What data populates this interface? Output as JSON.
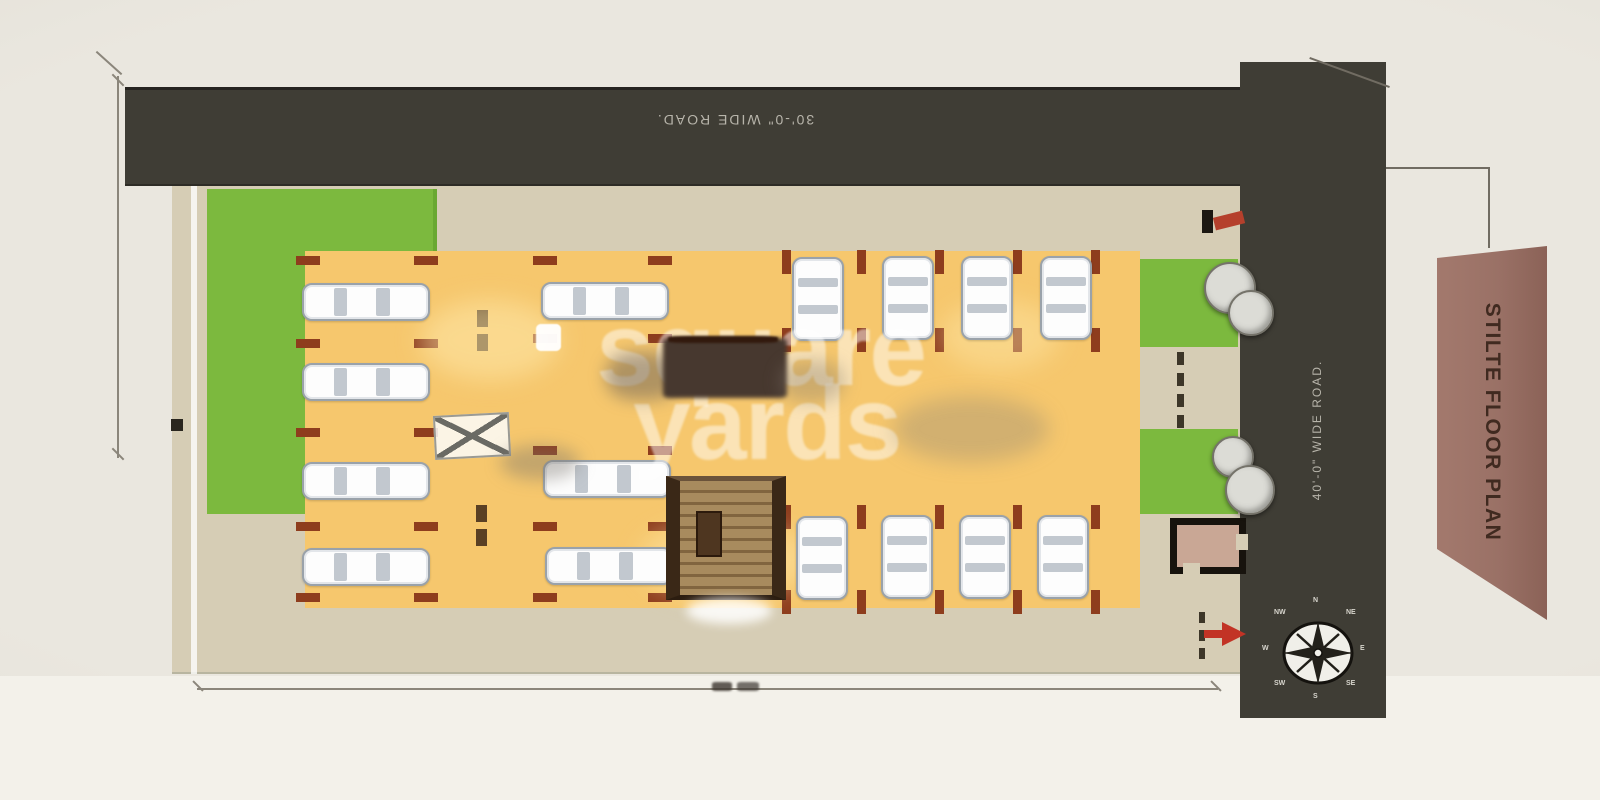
{
  "banner": {
    "label": "STILTE FLOOR PLAN"
  },
  "roads": {
    "top_label": "30'-0\" WIDE ROAD.",
    "right_label": "40'-0\" WIDE ROAD."
  },
  "watermark": {
    "word1": "square",
    "word2": "yards"
  },
  "compass": {
    "labels": [
      {
        "t": "N",
        "x": 1313,
        "y": 597
      },
      {
        "t": "NE",
        "x": 1346,
        "y": 609
      },
      {
        "t": "E",
        "x": 1360,
        "y": 645
      },
      {
        "t": "SE",
        "x": 1346,
        "y": 680
      },
      {
        "t": "S",
        "x": 1313,
        "y": 693
      },
      {
        "t": "SW",
        "x": 1274,
        "y": 680
      },
      {
        "t": "W",
        "x": 1262,
        "y": 645
      },
      {
        "t": "NW",
        "x": 1274,
        "y": 609
      }
    ]
  },
  "colors": {
    "road": "#3f3d35",
    "plot": "#d6cdb5",
    "grass": "#7cb93e",
    "parking": "#f6c76d",
    "marker": "#8e3d1d",
    "banner": "#9a7166",
    "banner_text": "#402a20",
    "arrow": "#c23325",
    "road_text": "#b7b4aa"
  },
  "plan": {
    "cars": [
      {
        "x": 302,
        "y": 283,
        "o": "h"
      },
      {
        "x": 302,
        "y": 363,
        "o": "h"
      },
      {
        "x": 302,
        "y": 462,
        "o": "h"
      },
      {
        "x": 302,
        "y": 548,
        "o": "h"
      },
      {
        "x": 541,
        "y": 282,
        "o": "h"
      },
      {
        "x": 543,
        "y": 460,
        "o": "h"
      },
      {
        "x": 545,
        "y": 547,
        "o": "h"
      },
      {
        "x": 792,
        "y": 257,
        "o": "v"
      },
      {
        "x": 882,
        "y": 256,
        "o": "v"
      },
      {
        "x": 961,
        "y": 256,
        "o": "v"
      },
      {
        "x": 1040,
        "y": 256,
        "o": "v"
      },
      {
        "x": 796,
        "y": 516,
        "o": "v"
      },
      {
        "x": 881,
        "y": 515,
        "o": "v"
      },
      {
        "x": 959,
        "y": 515,
        "o": "v"
      },
      {
        "x": 1037,
        "y": 515,
        "o": "v"
      }
    ],
    "rects": [
      {
        "x": 296,
        "y": 256,
        "w": 24,
        "h": 9,
        "n": "stall-marker"
      },
      {
        "x": 296,
        "y": 339,
        "w": 24,
        "h": 9,
        "n": "stall-marker"
      },
      {
        "x": 296,
        "y": 428,
        "w": 24,
        "h": 9,
        "n": "stall-marker"
      },
      {
        "x": 296,
        "y": 522,
        "w": 24,
        "h": 9,
        "n": "stall-marker"
      },
      {
        "x": 296,
        "y": 593,
        "w": 24,
        "h": 9,
        "n": "stall-marker"
      },
      {
        "x": 414,
        "y": 256,
        "w": 24,
        "h": 9,
        "n": "stall-marker"
      },
      {
        "x": 414,
        "y": 339,
        "w": 24,
        "h": 9,
        "n": "stall-marker"
      },
      {
        "x": 414,
        "y": 428,
        "w": 24,
        "h": 9,
        "n": "stall-marker"
      },
      {
        "x": 414,
        "y": 522,
        "w": 24,
        "h": 9,
        "n": "stall-marker"
      },
      {
        "x": 414,
        "y": 593,
        "w": 24,
        "h": 9,
        "n": "stall-marker"
      },
      {
        "x": 533,
        "y": 256,
        "w": 24,
        "h": 9,
        "n": "stall-marker"
      },
      {
        "x": 533,
        "y": 334,
        "w": 24,
        "h": 9,
        "n": "stall-marker"
      },
      {
        "x": 533,
        "y": 446,
        "w": 24,
        "h": 9,
        "n": "stall-marker"
      },
      {
        "x": 533,
        "y": 522,
        "w": 24,
        "h": 9,
        "n": "stall-marker"
      },
      {
        "x": 533,
        "y": 593,
        "w": 24,
        "h": 9,
        "n": "stall-marker"
      },
      {
        "x": 648,
        "y": 256,
        "w": 24,
        "h": 9,
        "n": "stall-marker"
      },
      {
        "x": 648,
        "y": 334,
        "w": 24,
        "h": 9,
        "n": "stall-marker"
      },
      {
        "x": 648,
        "y": 446,
        "w": 24,
        "h": 9,
        "n": "stall-marker"
      },
      {
        "x": 648,
        "y": 522,
        "w": 24,
        "h": 9,
        "n": "stall-marker"
      },
      {
        "x": 648,
        "y": 593,
        "w": 24,
        "h": 9,
        "n": "stall-marker"
      },
      {
        "x": 782,
        "y": 250,
        "w": 9,
        "h": 24,
        "n": "stall-marker"
      },
      {
        "x": 857,
        "y": 250,
        "w": 9,
        "h": 24,
        "n": "stall-marker"
      },
      {
        "x": 935,
        "y": 250,
        "w": 9,
        "h": 24,
        "n": "stall-marker"
      },
      {
        "x": 1013,
        "y": 250,
        "w": 9,
        "h": 24,
        "n": "stall-marker"
      },
      {
        "x": 1091,
        "y": 250,
        "w": 9,
        "h": 24,
        "n": "stall-marker"
      },
      {
        "x": 782,
        "y": 328,
        "w": 9,
        "h": 24,
        "n": "stall-marker"
      },
      {
        "x": 857,
        "y": 328,
        "w": 9,
        "h": 24,
        "n": "stall-marker"
      },
      {
        "x": 935,
        "y": 328,
        "w": 9,
        "h": 24,
        "n": "stall-marker"
      },
      {
        "x": 1013,
        "y": 328,
        "w": 9,
        "h": 24,
        "n": "stall-marker"
      },
      {
        "x": 1091,
        "y": 328,
        "w": 9,
        "h": 24,
        "n": "stall-marker"
      },
      {
        "x": 782,
        "y": 505,
        "w": 9,
        "h": 24,
        "n": "stall-marker"
      },
      {
        "x": 857,
        "y": 505,
        "w": 9,
        "h": 24,
        "n": "stall-marker"
      },
      {
        "x": 935,
        "y": 505,
        "w": 9,
        "h": 24,
        "n": "stall-marker"
      },
      {
        "x": 1013,
        "y": 505,
        "w": 9,
        "h": 24,
        "n": "stall-marker"
      },
      {
        "x": 1091,
        "y": 505,
        "w": 9,
        "h": 24,
        "n": "stall-marker"
      },
      {
        "x": 782,
        "y": 590,
        "w": 9,
        "h": 24,
        "n": "stall-marker"
      },
      {
        "x": 857,
        "y": 590,
        "w": 9,
        "h": 24,
        "n": "stall-marker"
      },
      {
        "x": 935,
        "y": 590,
        "w": 9,
        "h": 24,
        "n": "stall-marker"
      },
      {
        "x": 1013,
        "y": 590,
        "w": 9,
        "h": 24,
        "n": "stall-marker"
      },
      {
        "x": 1091,
        "y": 590,
        "w": 9,
        "h": 24,
        "n": "stall-marker"
      },
      {
        "x": 477,
        "y": 310,
        "w": 11,
        "h": 17,
        "c": "#5a4024",
        "n": "column-marker"
      },
      {
        "x": 477,
        "y": 334,
        "w": 11,
        "h": 17,
        "c": "#5a4024",
        "n": "column-marker"
      },
      {
        "x": 476,
        "y": 505,
        "w": 11,
        "h": 17,
        "c": "#5a4024",
        "n": "column-marker"
      },
      {
        "x": 476,
        "y": 529,
        "w": 11,
        "h": 17,
        "c": "#5a4024",
        "n": "column-marker"
      },
      {
        "x": 1177,
        "y": 352,
        "w": 7,
        "h": 13,
        "c": "#3d3628",
        "n": "walkway-dash"
      },
      {
        "x": 1177,
        "y": 373,
        "w": 7,
        "h": 13,
        "c": "#3d3628",
        "n": "walkway-dash"
      },
      {
        "x": 1177,
        "y": 394,
        "w": 7,
        "h": 13,
        "c": "#3d3628",
        "n": "walkway-dash"
      },
      {
        "x": 1177,
        "y": 415,
        "w": 7,
        "h": 13,
        "c": "#3d3628",
        "n": "walkway-dash"
      },
      {
        "x": 1199,
        "y": 612,
        "w": 6,
        "h": 11,
        "c": "#3d3628",
        "n": "gate-dash"
      },
      {
        "x": 1199,
        "y": 630,
        "w": 6,
        "h": 11,
        "c": "#3d3628",
        "n": "gate-dash"
      },
      {
        "x": 1199,
        "y": 648,
        "w": 6,
        "h": 11,
        "c": "#3d3628",
        "n": "gate-dash"
      },
      {
        "x": 1202,
        "y": 210,
        "w": 11,
        "h": 23,
        "c": "#1c1812",
        "n": "boundary-post"
      },
      {
        "x": 1214,
        "y": 214,
        "w": 30,
        "h": 13,
        "c": "#b5402c",
        "rot": -14,
        "n": "entry-mark"
      },
      {
        "x": 171,
        "y": 419,
        "w": 12,
        "h": 12,
        "c": "#2a261f",
        "n": "boundary-dot"
      },
      {
        "x": 420,
        "y": 300,
        "w": 140,
        "h": 80,
        "c": "rgba(255,236,175,0.5)",
        "b": 12,
        "r": 50,
        "n": "light-wash"
      },
      {
        "x": 640,
        "y": 520,
        "w": 170,
        "h": 80,
        "c": "rgba(255,236,175,0.45)",
        "b": 12,
        "r": 50,
        "n": "light-wash"
      },
      {
        "x": 940,
        "y": 300,
        "w": 120,
        "h": 70,
        "c": "rgba(255,236,175,0.4)",
        "b": 12,
        "r": 50,
        "n": "light-wash"
      }
    ],
    "smudges": [
      {
        "x": 606,
        "y": 352,
        "w": 74,
        "h": 48,
        "c": "rgba(105,95,88,0.5)",
        "b": 8,
        "r": 40,
        "n": "blur-smudge"
      },
      {
        "x": 663,
        "y": 338,
        "w": 124,
        "h": 60,
        "c": "#47382f",
        "b": 2,
        "r": 6,
        "n": "blurred-car"
      },
      {
        "x": 668,
        "y": 336,
        "w": 110,
        "h": 7,
        "c": "#32190d",
        "b": 1,
        "r": 20,
        "n": "blurred-car-edge"
      },
      {
        "x": 780,
        "y": 360,
        "w": 64,
        "h": 42,
        "c": "rgba(130,120,110,0.35)",
        "b": 8,
        "r": 40,
        "n": "blur-smudge"
      },
      {
        "x": 893,
        "y": 396,
        "w": 156,
        "h": 66,
        "c": "rgba(126,122,118,0.3)",
        "b": 10,
        "r": 50,
        "n": "blur-smudge"
      },
      {
        "x": 500,
        "y": 445,
        "w": 80,
        "h": 35,
        "c": "rgba(120,115,108,0.4)",
        "b": 8,
        "r": 50,
        "n": "blur-smudge"
      },
      {
        "x": 686,
        "y": 598,
        "w": 86,
        "h": 26,
        "c": "rgba(255,255,255,0.85)",
        "b": 5,
        "r": 50,
        "n": "stair-landing"
      },
      {
        "x": 712,
        "y": 682,
        "w": 20,
        "h": 9,
        "c": "rgba(60,54,48,0.8)",
        "b": 1,
        "r": 20,
        "n": "dimension-text-smudge"
      },
      {
        "x": 737,
        "y": 682,
        "w": 22,
        "h": 9,
        "c": "rgba(60,54,48,0.7)",
        "b": 1,
        "r": 20,
        "n": "dimension-text-smudge"
      }
    ],
    "trees": [
      {
        "x": 1204,
        "y": 262,
        "d": 52
      },
      {
        "x": 1228,
        "y": 290,
        "d": 46
      },
      {
        "x": 1212,
        "y": 436,
        "d": 42
      },
      {
        "x": 1225,
        "y": 465,
        "d": 50
      }
    ]
  }
}
